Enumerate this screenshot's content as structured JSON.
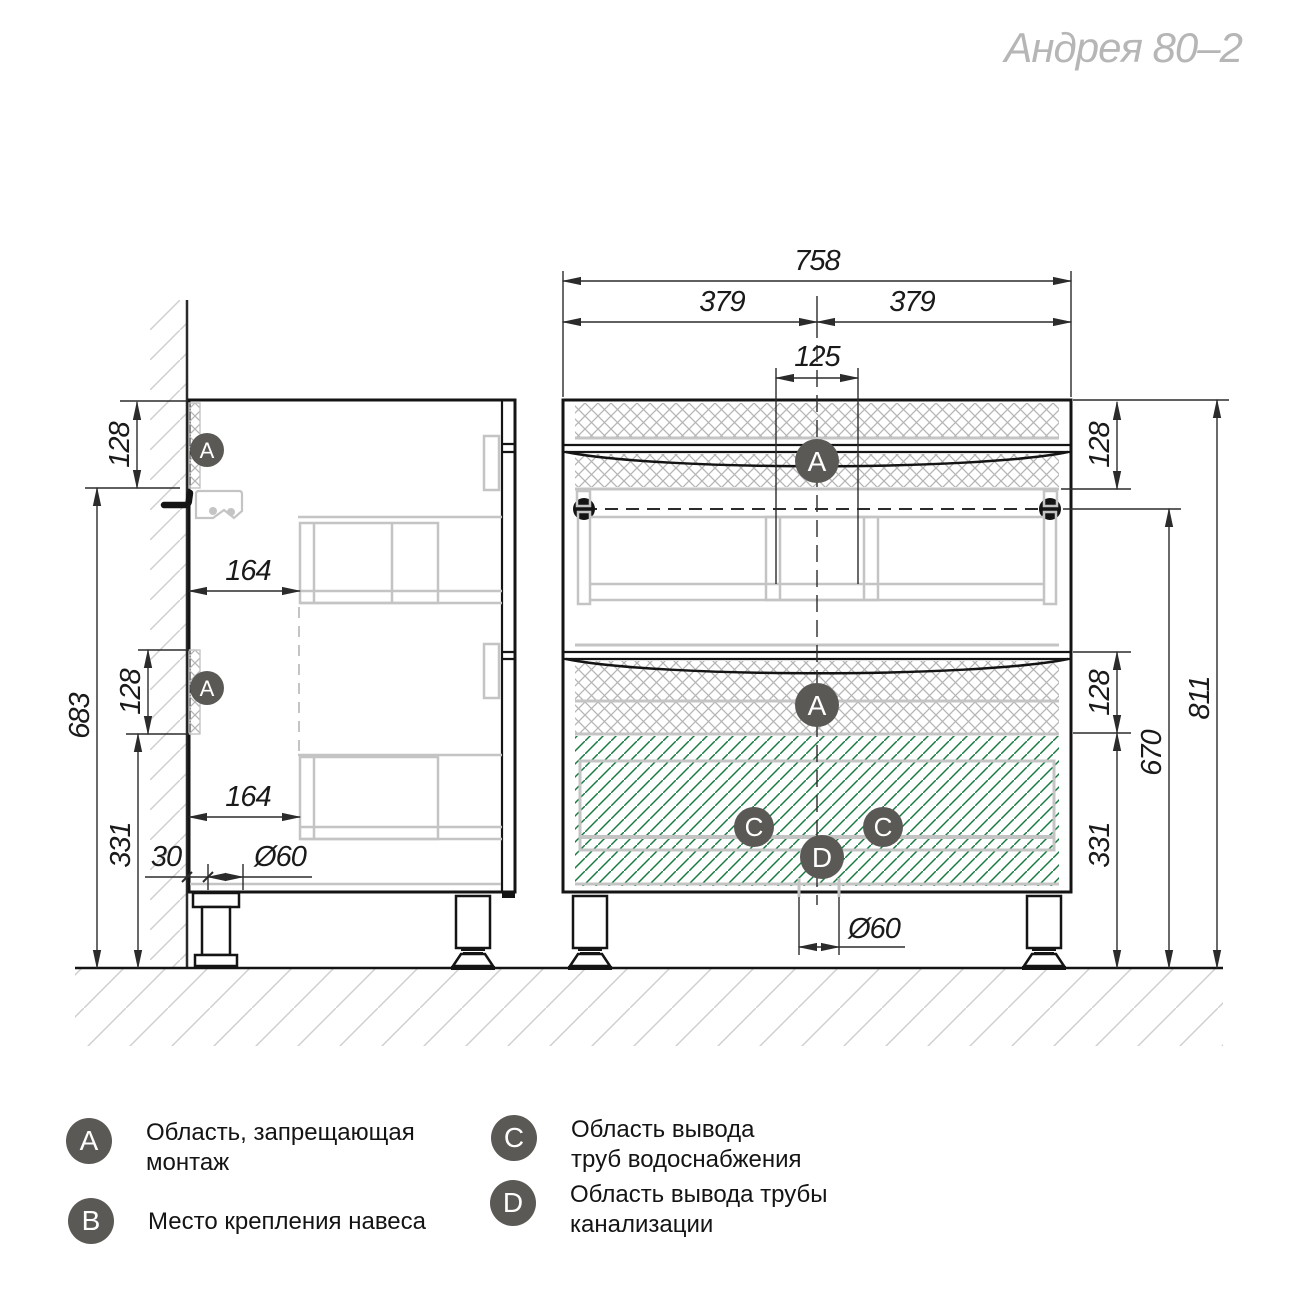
{
  "title": "Андрея 80–2",
  "dims": {
    "overall_width": "758",
    "left_half": "379",
    "right_half": "379",
    "sink_zone": "125",
    "front_top_zone": "128",
    "front_mid_zone": "128",
    "front_bottom_zone": "331",
    "hanger_to_floor": "670",
    "total_height": "811",
    "drain_front": "Ø60",
    "side_top_zone": "128",
    "wall_mount_height": "683",
    "side_mid_zone": "128",
    "side_bottom_zone": "331",
    "drawer_inset_upper": "164",
    "drawer_inset_lower": "164",
    "wall_gap": "30",
    "drain_side": "Ø60"
  },
  "badge_letters": {
    "a": "A",
    "c": "C",
    "d": "D"
  },
  "legend": [
    {
      "badge": "A",
      "line1": "Область, запрещающая",
      "line2": "монтаж"
    },
    {
      "badge": "B",
      "line1": "Место крепления навеса",
      "line2": ""
    },
    {
      "badge": "C",
      "line1": "Область вывода",
      "line2": "труб водоснабжения"
    },
    {
      "badge": "D",
      "line1": "Область вывода трубы",
      "line2": "канализации"
    }
  ],
  "colors": {
    "badge": "#5b5955",
    "line": "#141414",
    "gray_detail": "#c4c4c4",
    "hatch_gray": "#b5b5b5",
    "hatch_green": "#177b41",
    "title_gray": "#b6b6b6"
  }
}
